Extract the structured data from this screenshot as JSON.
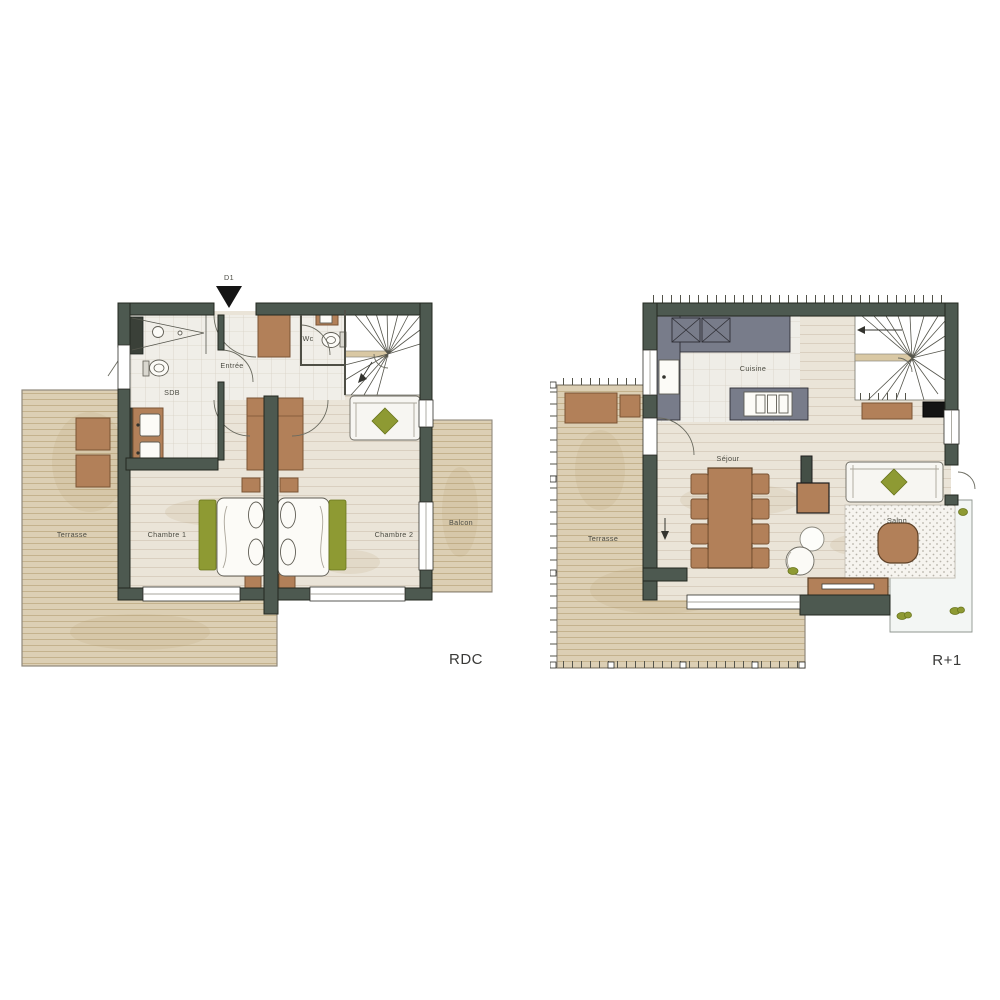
{
  "page": {
    "background": "#ffffff"
  },
  "colors": {
    "wall": "#4d5950",
    "wall_outline": "#23281f",
    "interior_wood": "#eae4d8",
    "terrace_wood": "#dccfb4",
    "tile": "#f0eee8",
    "furniture_brown": "#b28059",
    "cushion_green": "#8e9a33",
    "kitchen_counter_gray": "#787c8a",
    "label_text": "#4b4b42"
  },
  "plans": {
    "rdc": {
      "floor_label": "RDC",
      "entry_door_label": "D1",
      "rooms": {
        "terrasse": "Terrasse",
        "sdb": "SDB",
        "entree": "Entrée",
        "wc": "Wc",
        "chambre1": "Chambre 1",
        "chambre2": "Chambre 2",
        "balcon": "Balcon"
      }
    },
    "r1": {
      "floor_label": "R+1",
      "rooms": {
        "terrasse": "Terrasse",
        "cuisine": "Cuisine",
        "sejour": "Séjour",
        "salon": "Salon"
      }
    }
  }
}
